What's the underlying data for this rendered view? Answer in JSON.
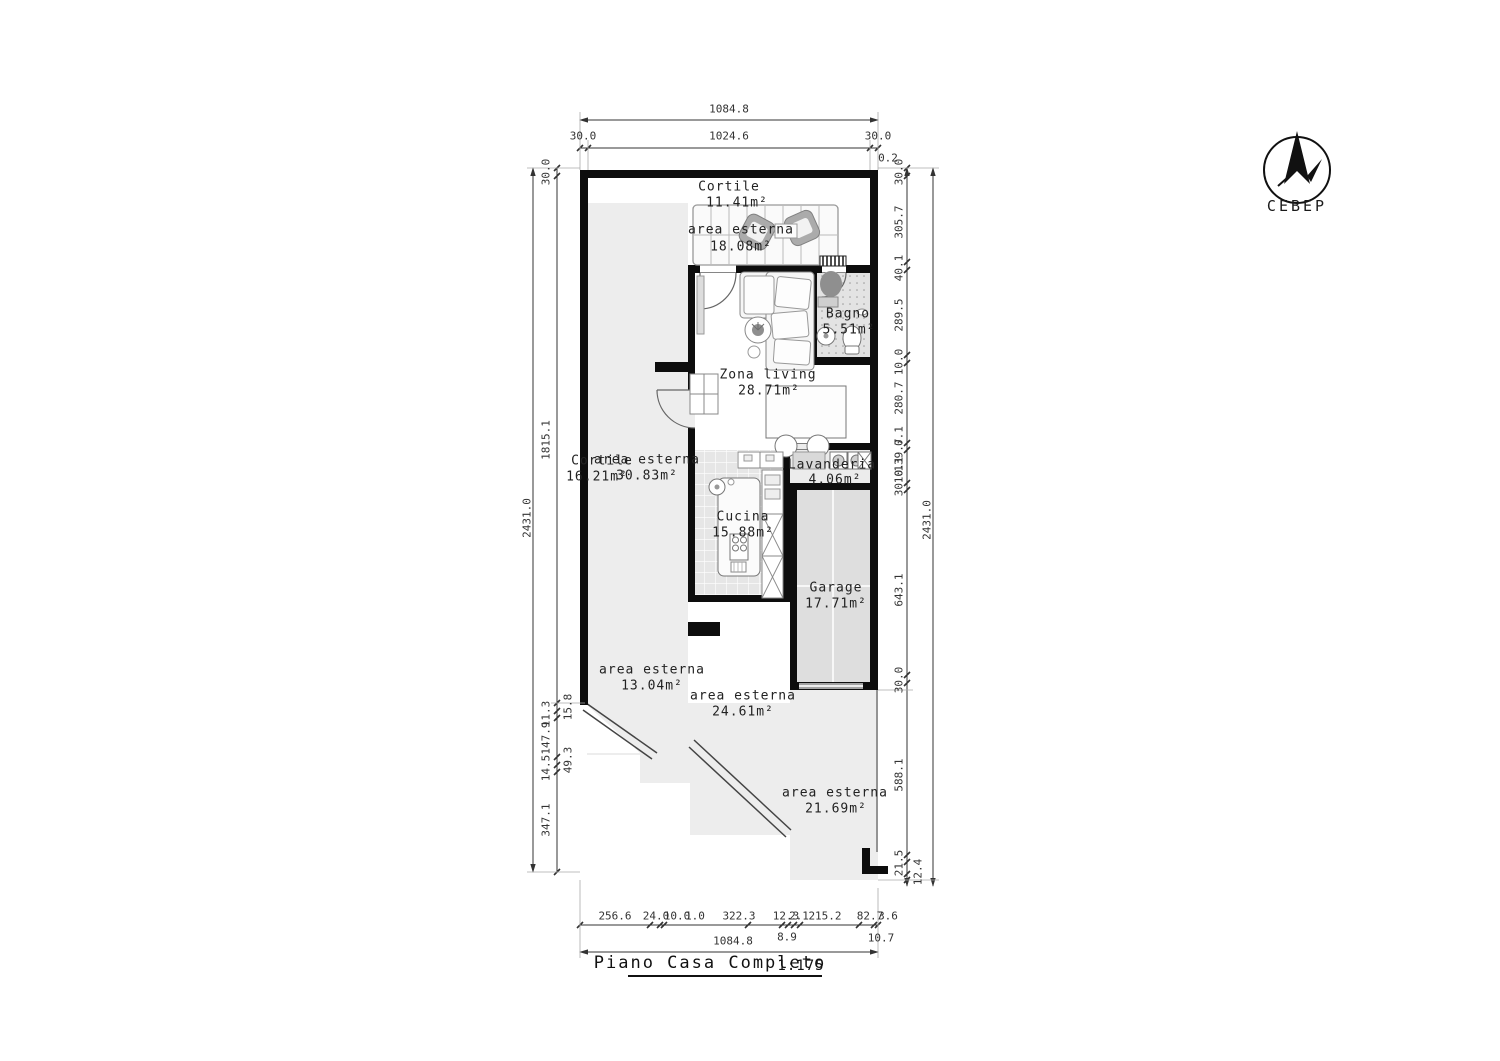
{
  "title": {
    "name": "Piano Casa Completo",
    "scale": "1:175"
  },
  "compass": {
    "label": "СЕВЕР"
  },
  "rooms": [
    {
      "name": "Cortile",
      "area": "11.41m²"
    },
    {
      "name": "area esterna",
      "area": "18.08m²"
    },
    {
      "name": "Bagno",
      "area": "5.51m²"
    },
    {
      "name": "Zona living",
      "area": "28.71m²"
    },
    {
      "name": "Cortile",
      "area": "16.21m²"
    },
    {
      "name": "area esterna",
      "area": "30.83m²"
    },
    {
      "name": "Lavanderia",
      "area": "4.06m²"
    },
    {
      "name": "Cucina",
      "area": "15.88m²"
    },
    {
      "name": "Garage",
      "area": "17.71m²"
    },
    {
      "name": "area esterna",
      "area": "13.04m²"
    },
    {
      "name": "area esterna",
      "area": "24.61m²"
    },
    {
      "name": "area esterna",
      "area": "21.69m²"
    }
  ],
  "dims": {
    "top": {
      "total": "1084.8",
      "row2": [
        "30.0",
        "1024.6",
        "30.0"
      ],
      "offset": "0.2"
    },
    "left": {
      "outer": "2431.0",
      "inner": [
        "30.0",
        "1815.1",
        "15.8",
        "11.3",
        "147.9",
        "49.3",
        "14.5",
        "347.1"
      ]
    },
    "right": {
      "outer": "2431.0",
      "inner": [
        "30.0",
        "305.7",
        "40.1",
        "289.5",
        "10.0",
        "280.7",
        "0.1",
        "139.7",
        "10.1",
        "30.0",
        "643.1",
        "30.0",
        "588.1",
        "21.5",
        "12.4"
      ]
    },
    "bottom": {
      "row1": [
        "256.6",
        "24.0",
        "10.0",
        "1.0",
        "322.3",
        "12.3",
        "2.1",
        "215.2",
        "82.7",
        "3.6"
      ],
      "below": [
        "8.9",
        "10.7"
      ],
      "total": "1084.8"
    }
  },
  "colors": {
    "wall": "#0d0d0d",
    "outdoor": "#ededed",
    "tile": "#e3e3e3",
    "furniture": "#ababab"
  }
}
